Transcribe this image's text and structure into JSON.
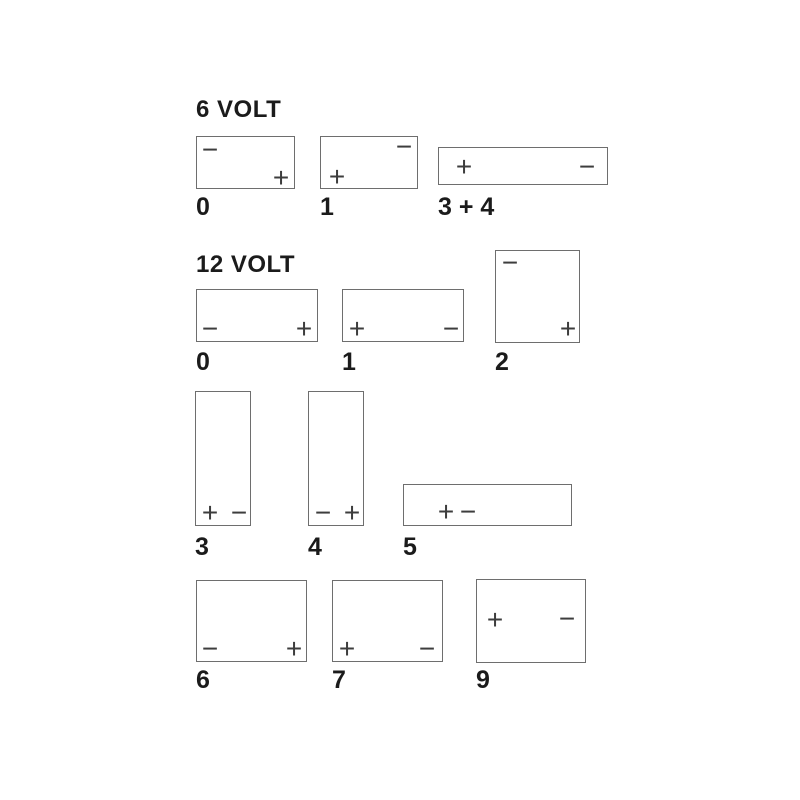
{
  "colors": {
    "background": "#ffffff",
    "box_border": "#6e6e6e",
    "symbol": "#3d3d3d",
    "text": "#1b1b1b"
  },
  "symbols": {
    "plus": "+",
    "minus": "−"
  },
  "sections": [
    {
      "heading": "6 VOLT",
      "heading_pos": {
        "x": 196,
        "y": 98
      },
      "layouts": [
        {
          "label": "0",
          "label_pos": {
            "x": 196,
            "y": 195
          },
          "box": {
            "x": 196,
            "y": 136,
            "w": 99,
            "h": 53
          },
          "terminals": [
            {
              "sign": "minus",
              "x": 13,
              "y": 13
            },
            {
              "sign": "plus",
              "x": 84,
              "y": 41
            }
          ]
        },
        {
          "label": "1",
          "label_pos": {
            "x": 320,
            "y": 195
          },
          "box": {
            "x": 320,
            "y": 136,
            "w": 98,
            "h": 53
          },
          "terminals": [
            {
              "sign": "plus",
              "x": 16,
              "y": 40
            },
            {
              "sign": "minus",
              "x": 83,
              "y": 10
            }
          ]
        },
        {
          "label": "3 + 4",
          "label_pos": {
            "x": 438,
            "y": 195
          },
          "box": {
            "x": 438,
            "y": 147,
            "w": 170,
            "h": 38
          },
          "terminals": [
            {
              "sign": "plus",
              "x": 25,
              "y": 19
            },
            {
              "sign": "minus",
              "x": 148,
              "y": 19
            }
          ]
        }
      ]
    },
    {
      "heading": "12 VOLT",
      "heading_pos": {
        "x": 196,
        "y": 253
      },
      "layouts": [
        {
          "label": "0",
          "label_pos": {
            "x": 196,
            "y": 350
          },
          "box": {
            "x": 196,
            "y": 289,
            "w": 122,
            "h": 53
          },
          "terminals": [
            {
              "sign": "minus",
              "x": 13,
              "y": 39
            },
            {
              "sign": "plus",
              "x": 107,
              "y": 39
            }
          ]
        },
        {
          "label": "1",
          "label_pos": {
            "x": 342,
            "y": 350
          },
          "box": {
            "x": 342,
            "y": 289,
            "w": 122,
            "h": 53
          },
          "terminals": [
            {
              "sign": "plus",
              "x": 14,
              "y": 39
            },
            {
              "sign": "minus",
              "x": 108,
              "y": 39
            }
          ]
        },
        {
          "label": "2",
          "label_pos": {
            "x": 495,
            "y": 350
          },
          "box": {
            "x": 495,
            "y": 250,
            "w": 85,
            "h": 93
          },
          "terminals": [
            {
              "sign": "minus",
              "x": 14,
              "y": 12
            },
            {
              "sign": "plus",
              "x": 72,
              "y": 78
            }
          ]
        },
        {
          "label": "3",
          "label_pos": {
            "x": 195,
            "y": 535
          },
          "box": {
            "x": 195,
            "y": 391,
            "w": 56,
            "h": 135
          },
          "terminals": [
            {
              "sign": "plus",
              "x": 14,
              "y": 121
            },
            {
              "sign": "minus",
              "x": 43,
              "y": 121
            }
          ]
        },
        {
          "label": "4",
          "label_pos": {
            "x": 308,
            "y": 535
          },
          "box": {
            "x": 308,
            "y": 391,
            "w": 56,
            "h": 135
          },
          "terminals": [
            {
              "sign": "minus",
              "x": 14,
              "y": 121
            },
            {
              "sign": "plus",
              "x": 43,
              "y": 121
            }
          ]
        },
        {
          "label": "5",
          "label_pos": {
            "x": 403,
            "y": 535
          },
          "box": {
            "x": 403,
            "y": 484,
            "w": 169,
            "h": 42
          },
          "terminals": [
            {
              "sign": "plus",
              "x": 42,
              "y": 27
            },
            {
              "sign": "minus",
              "x": 64,
              "y": 27
            }
          ]
        },
        {
          "label": "6",
          "label_pos": {
            "x": 196,
            "y": 668
          },
          "box": {
            "x": 196,
            "y": 580,
            "w": 111,
            "h": 82
          },
          "terminals": [
            {
              "sign": "minus",
              "x": 13,
              "y": 68
            },
            {
              "sign": "plus",
              "x": 97,
              "y": 68
            }
          ]
        },
        {
          "label": "7",
          "label_pos": {
            "x": 332,
            "y": 668
          },
          "box": {
            "x": 332,
            "y": 580,
            "w": 111,
            "h": 82
          },
          "terminals": [
            {
              "sign": "plus",
              "x": 14,
              "y": 68
            },
            {
              "sign": "minus",
              "x": 94,
              "y": 68
            }
          ]
        },
        {
          "label": "9",
          "label_pos": {
            "x": 476,
            "y": 668
          },
          "box": {
            "x": 476,
            "y": 579,
            "w": 110,
            "h": 84
          },
          "terminals": [
            {
              "sign": "plus",
              "x": 18,
              "y": 40
            },
            {
              "sign": "minus",
              "x": 90,
              "y": 39
            }
          ]
        }
      ]
    }
  ]
}
